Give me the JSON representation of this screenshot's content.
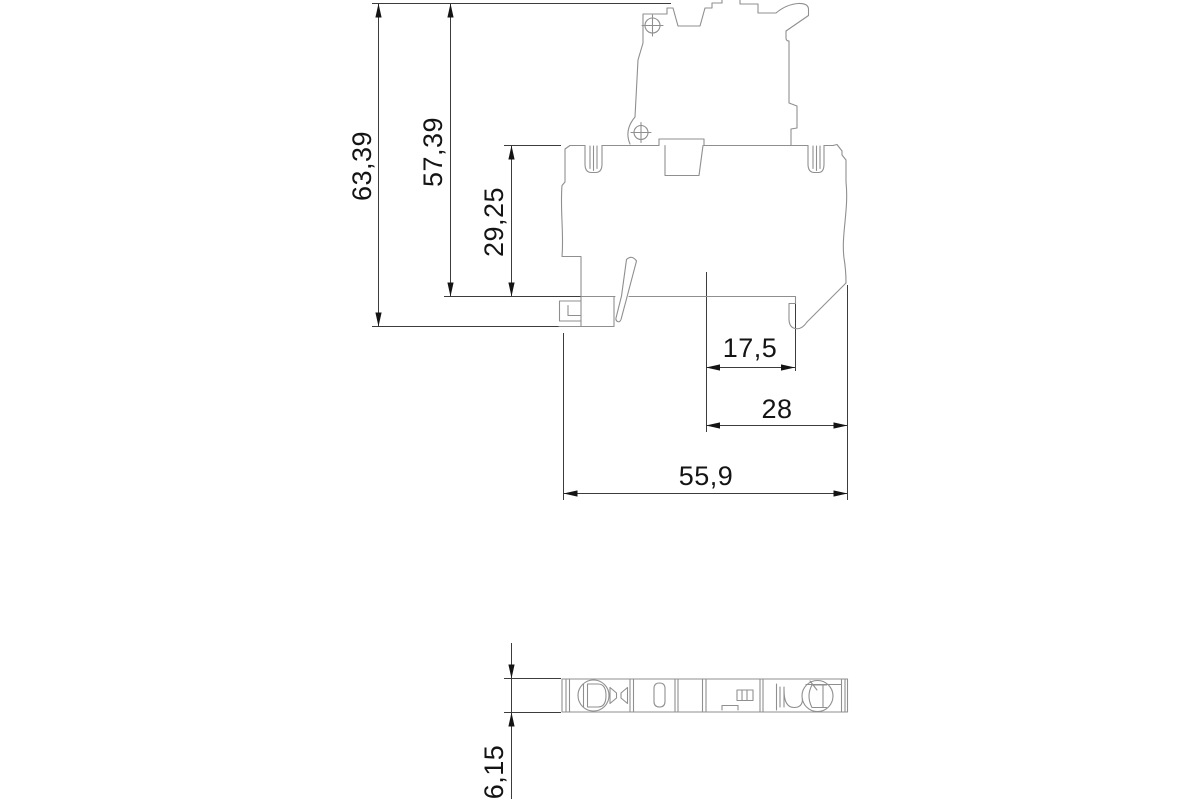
{
  "drawing": {
    "background": "#ffffff",
    "colors": {
      "part_outline": "#8f8f8f",
      "dimension": "#3c3c3c",
      "text": "#141414"
    },
    "dimensions": {
      "total_height": "63,39",
      "upper_height": "57,39",
      "body_height": "29,25",
      "inner_width": "17,5",
      "mid_width": "28",
      "total_width": "55,9",
      "profile_thickness": "6,15"
    }
  }
}
